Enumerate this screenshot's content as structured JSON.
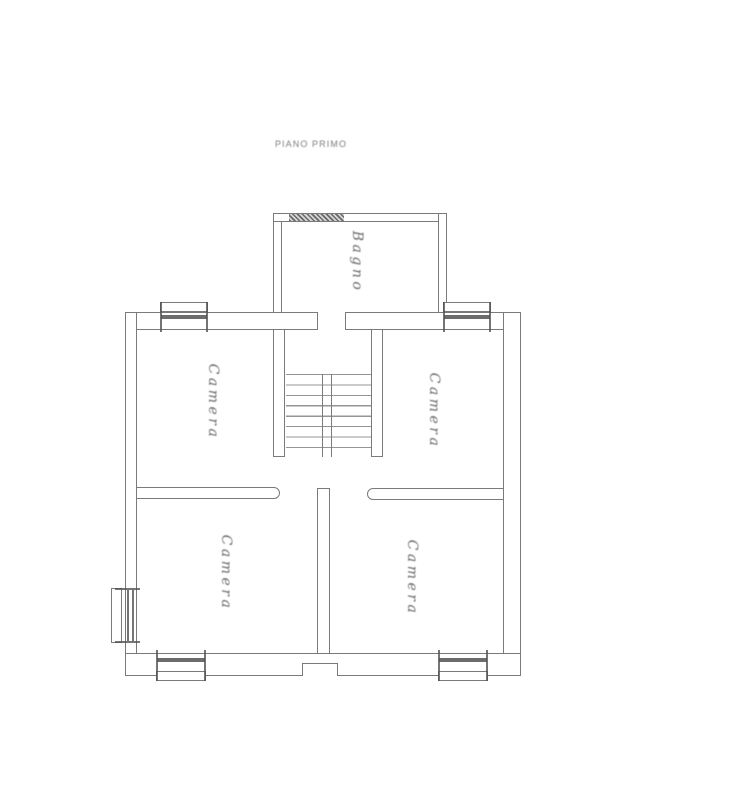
{
  "title": "PIANO PRIMO",
  "rooms": {
    "bagno": {
      "label": "Bagno"
    },
    "camera_top_left": {
      "label": "Camera"
    },
    "camera_top_right": {
      "label": "Camera"
    },
    "camera_bottom_left": {
      "label": "Camera"
    },
    "camera_bottom_right": {
      "label": "Camera"
    }
  },
  "colors": {
    "line": "#7a7a7a",
    "dark": "#525252",
    "text": "#6a6a6a",
    "background": "#ffffff"
  }
}
